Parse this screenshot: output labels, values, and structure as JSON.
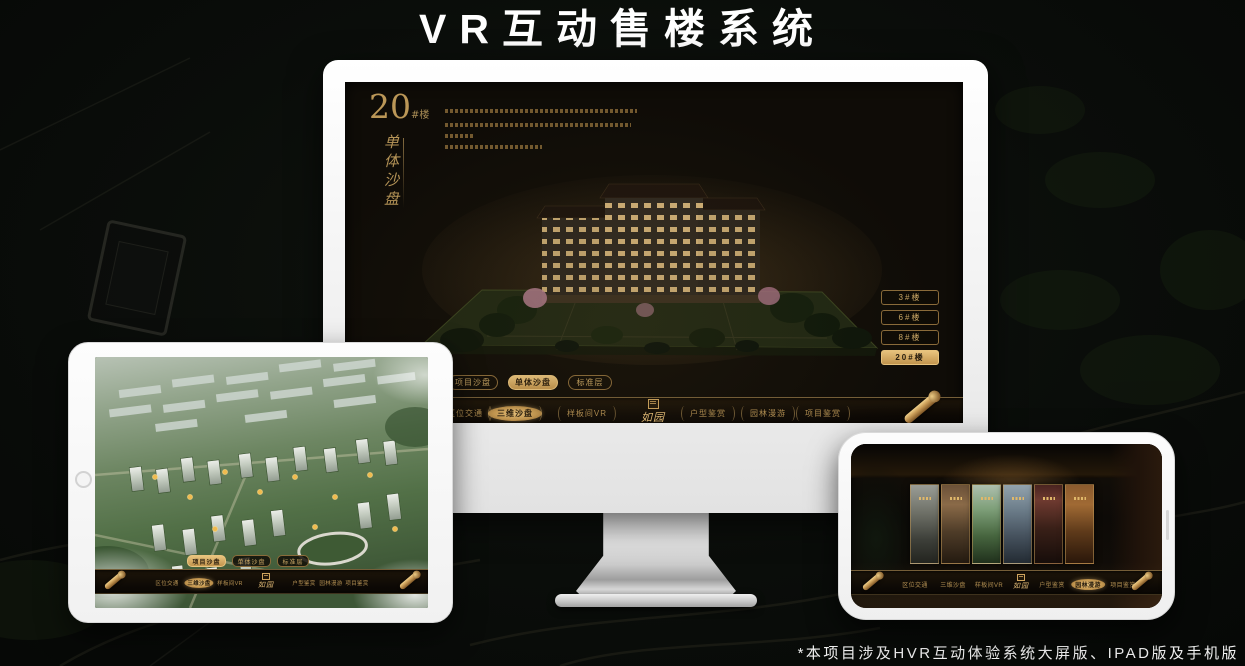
{
  "page": {
    "title": "VR互动售楼系统",
    "footnote": "*本项目涉及HVR互动体验系统大屏版、IPAD版及手机版"
  },
  "app": {
    "brand_logo": "如园",
    "nav_items": [
      {
        "label": "区位交通"
      },
      {
        "label": "三维沙盘"
      },
      {
        "label": "样板间VR"
      },
      {
        "label": "户型鉴赏"
      },
      {
        "label": "园林漫游"
      },
      {
        "label": "项目鉴赏"
      }
    ],
    "view_tabs": [
      {
        "label": "项目沙盘"
      },
      {
        "label": "单体沙盘"
      },
      {
        "label": "标准层"
      }
    ]
  },
  "monitor": {
    "building_number": "20",
    "building_number_suffix": "#楼",
    "panel_title_vertical": "单体沙盘",
    "floor_buttons": [
      {
        "label": "3#楼"
      },
      {
        "label": "6#楼"
      },
      {
        "label": "8#楼"
      },
      {
        "label": "20#楼"
      }
    ],
    "selected_floor": "20#楼",
    "selected_tab": "单体沙盘",
    "selected_nav": "三维沙盘"
  },
  "ipad": {
    "selected_tab": "项目沙盘",
    "selected_nav": "三维沙盘"
  },
  "phone": {
    "selected_nav": "园林漫游"
  },
  "colors": {
    "accent_gold": "#c9a264",
    "accent_gold_fill": "#d9ae66",
    "title_white": "#ffffff",
    "screen_dark": "#0f0c07"
  }
}
